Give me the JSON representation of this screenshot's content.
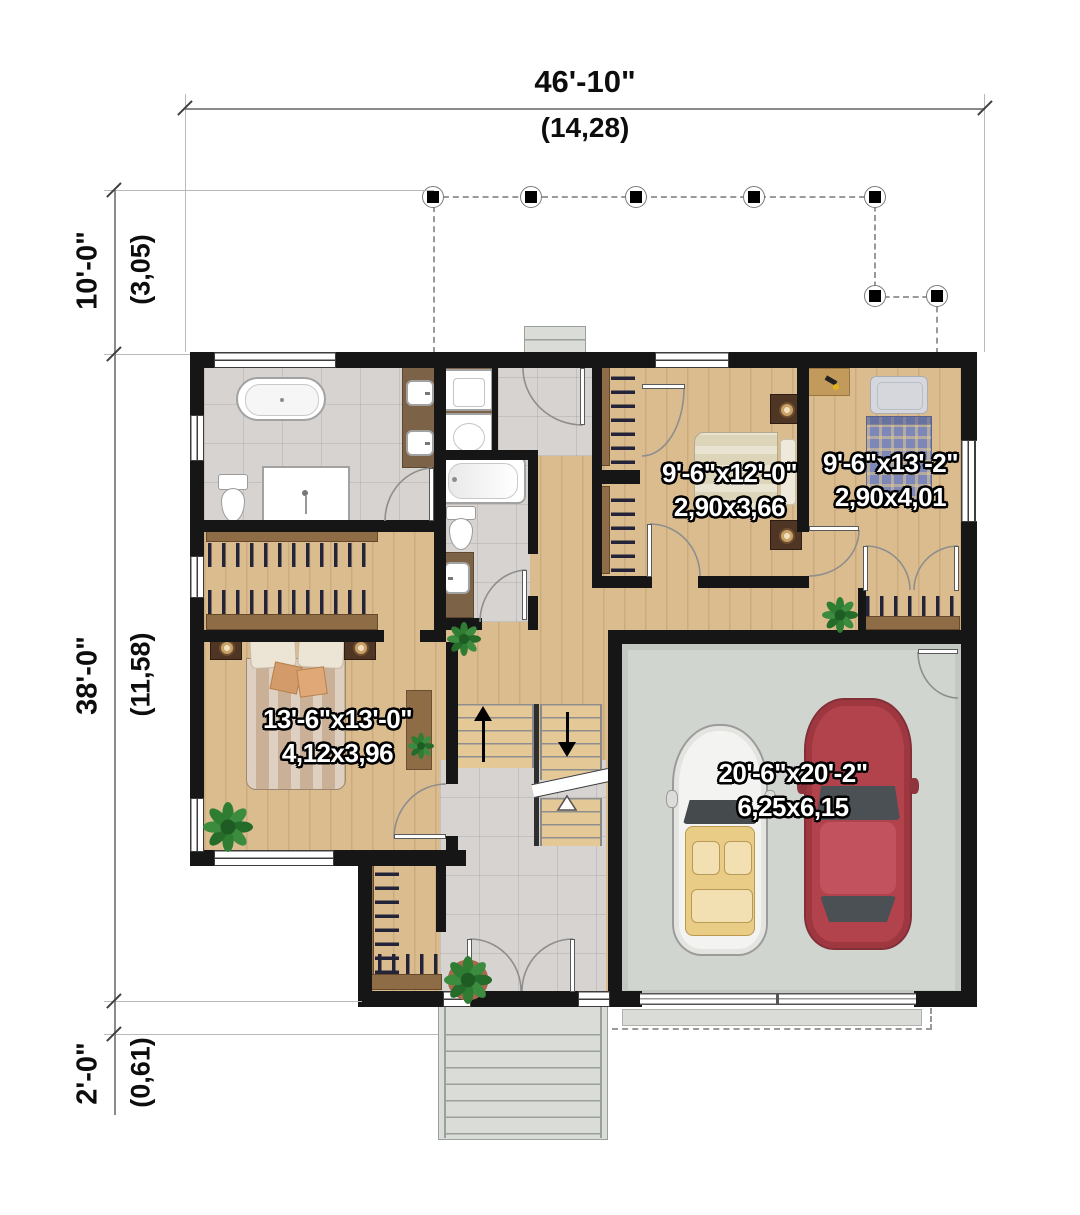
{
  "dimensions": {
    "width_top": {
      "imperial": "46'-10\"",
      "metric": "(14,28)"
    },
    "porch_depth": {
      "imperial": "10'-0\"",
      "metric": "(3,05)"
    },
    "house_depth": {
      "imperial": "38'-0\"",
      "metric": "(11,58)"
    },
    "stoop_depth": {
      "imperial": "2'-0\"",
      "metric": "(0,61)"
    }
  },
  "rooms": {
    "master_bedroom": {
      "imperial": "13'-6\"x13'-0\"",
      "metric": "4,12x3,96"
    },
    "bedroom_2": {
      "imperial": "9'-6\"x12'-0\"",
      "metric": "2,90x3,66"
    },
    "bedroom_3": {
      "imperial": "9'-6\"x13'-2\"",
      "metric": "2,90x4,01"
    },
    "garage": {
      "imperial": "20'-6\"x20'-2\"",
      "metric": "6,25x6,15"
    }
  },
  "colors": {
    "wall": "#161616",
    "wood_floor": "#dbbc8e",
    "tile_floor": "#d6d3d0",
    "garage_floor": "#d1d5d0",
    "concrete": "#dadcd7",
    "closet_wood": "#8d6c46",
    "car_red": "#b2434c",
    "car_white": "#f3f3f1",
    "plant_green": "#2e7d32",
    "label_text": "#ffffff"
  }
}
